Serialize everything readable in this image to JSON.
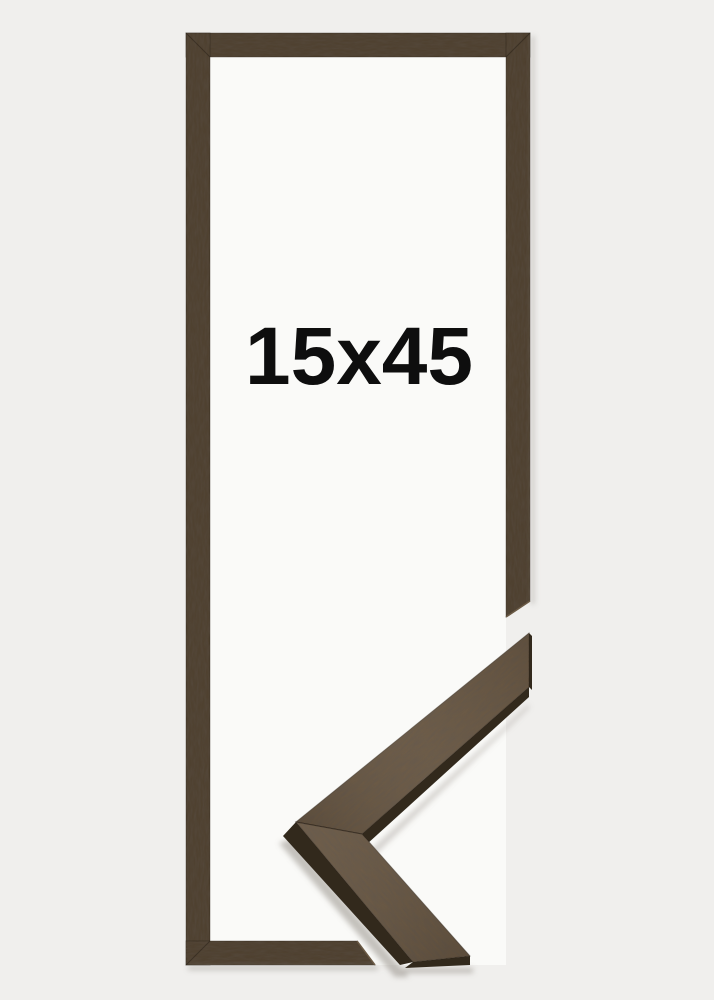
{
  "image": {
    "label": "15x45",
    "label_color": "#0e0e0e",
    "background_color": "#f0efed"
  },
  "frame": {
    "opening_color": "#fafaf8",
    "wood_color": "#4f4130",
    "wood_dark": "#2e2418"
  },
  "sample": {
    "face_color": "#685641",
    "side_color": "#32291c"
  }
}
